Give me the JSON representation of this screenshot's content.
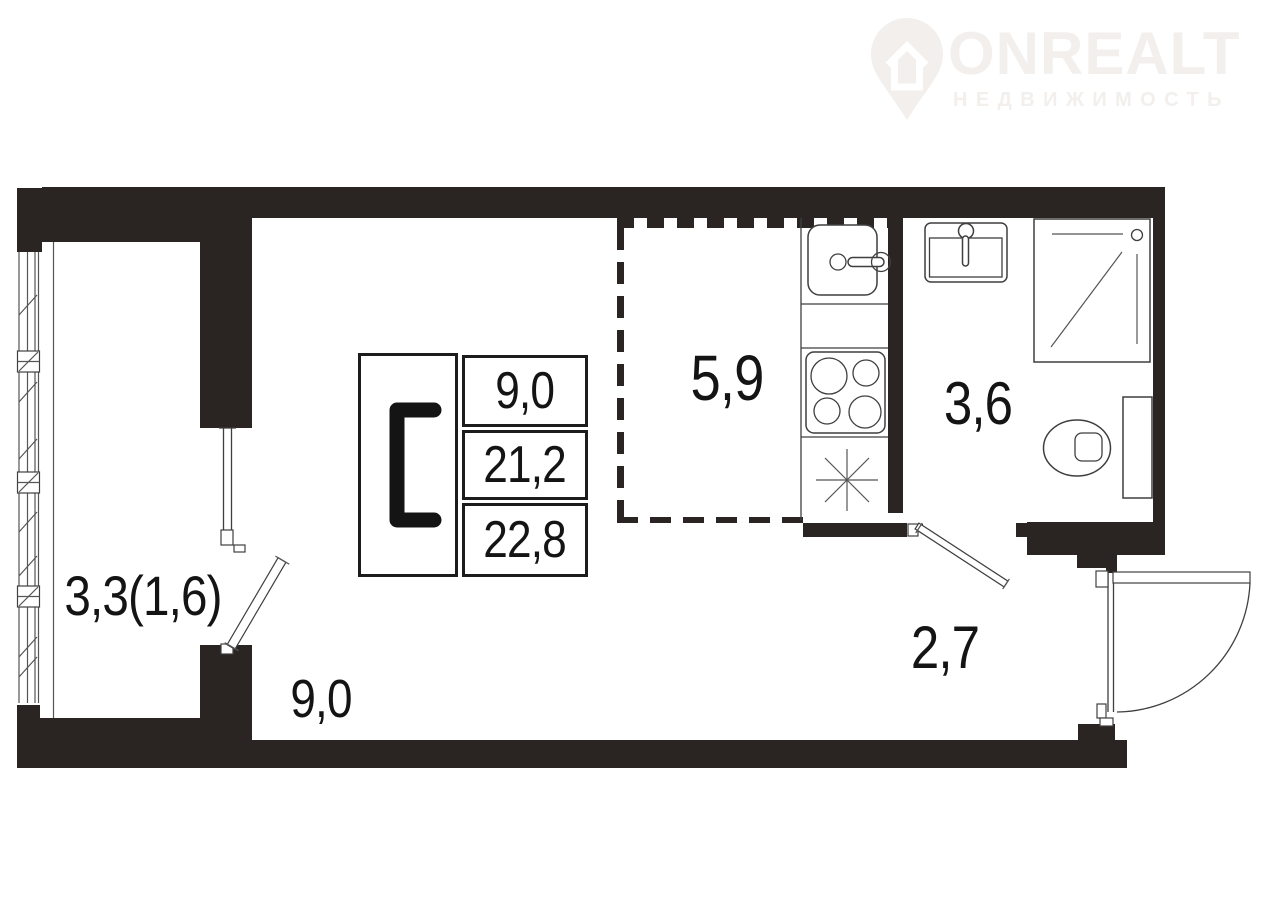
{
  "logo": {
    "brand": "ONREALT",
    "subtitle": "НЕДВИЖИМОСТЬ",
    "icon": "house-location-pin-icon",
    "color": "#f2efed"
  },
  "legend": {
    "type": "С",
    "values": [
      "9,0",
      "21,2",
      "22,8"
    ]
  },
  "rooms": [
    {
      "name": "kitchen-zone",
      "area": "5,9"
    },
    {
      "name": "bathroom",
      "area": "3,6"
    },
    {
      "name": "hallway",
      "area": "2,7"
    },
    {
      "name": "main-room",
      "area": "9,0"
    },
    {
      "name": "balcony",
      "area": "3,3(1,6)"
    }
  ],
  "colors": {
    "wall": "#2a2522",
    "line": "#3f3f3f",
    "thin_line": "#555555",
    "text": "#141414",
    "logo": "#f2efed",
    "background": "#ffffff"
  }
}
